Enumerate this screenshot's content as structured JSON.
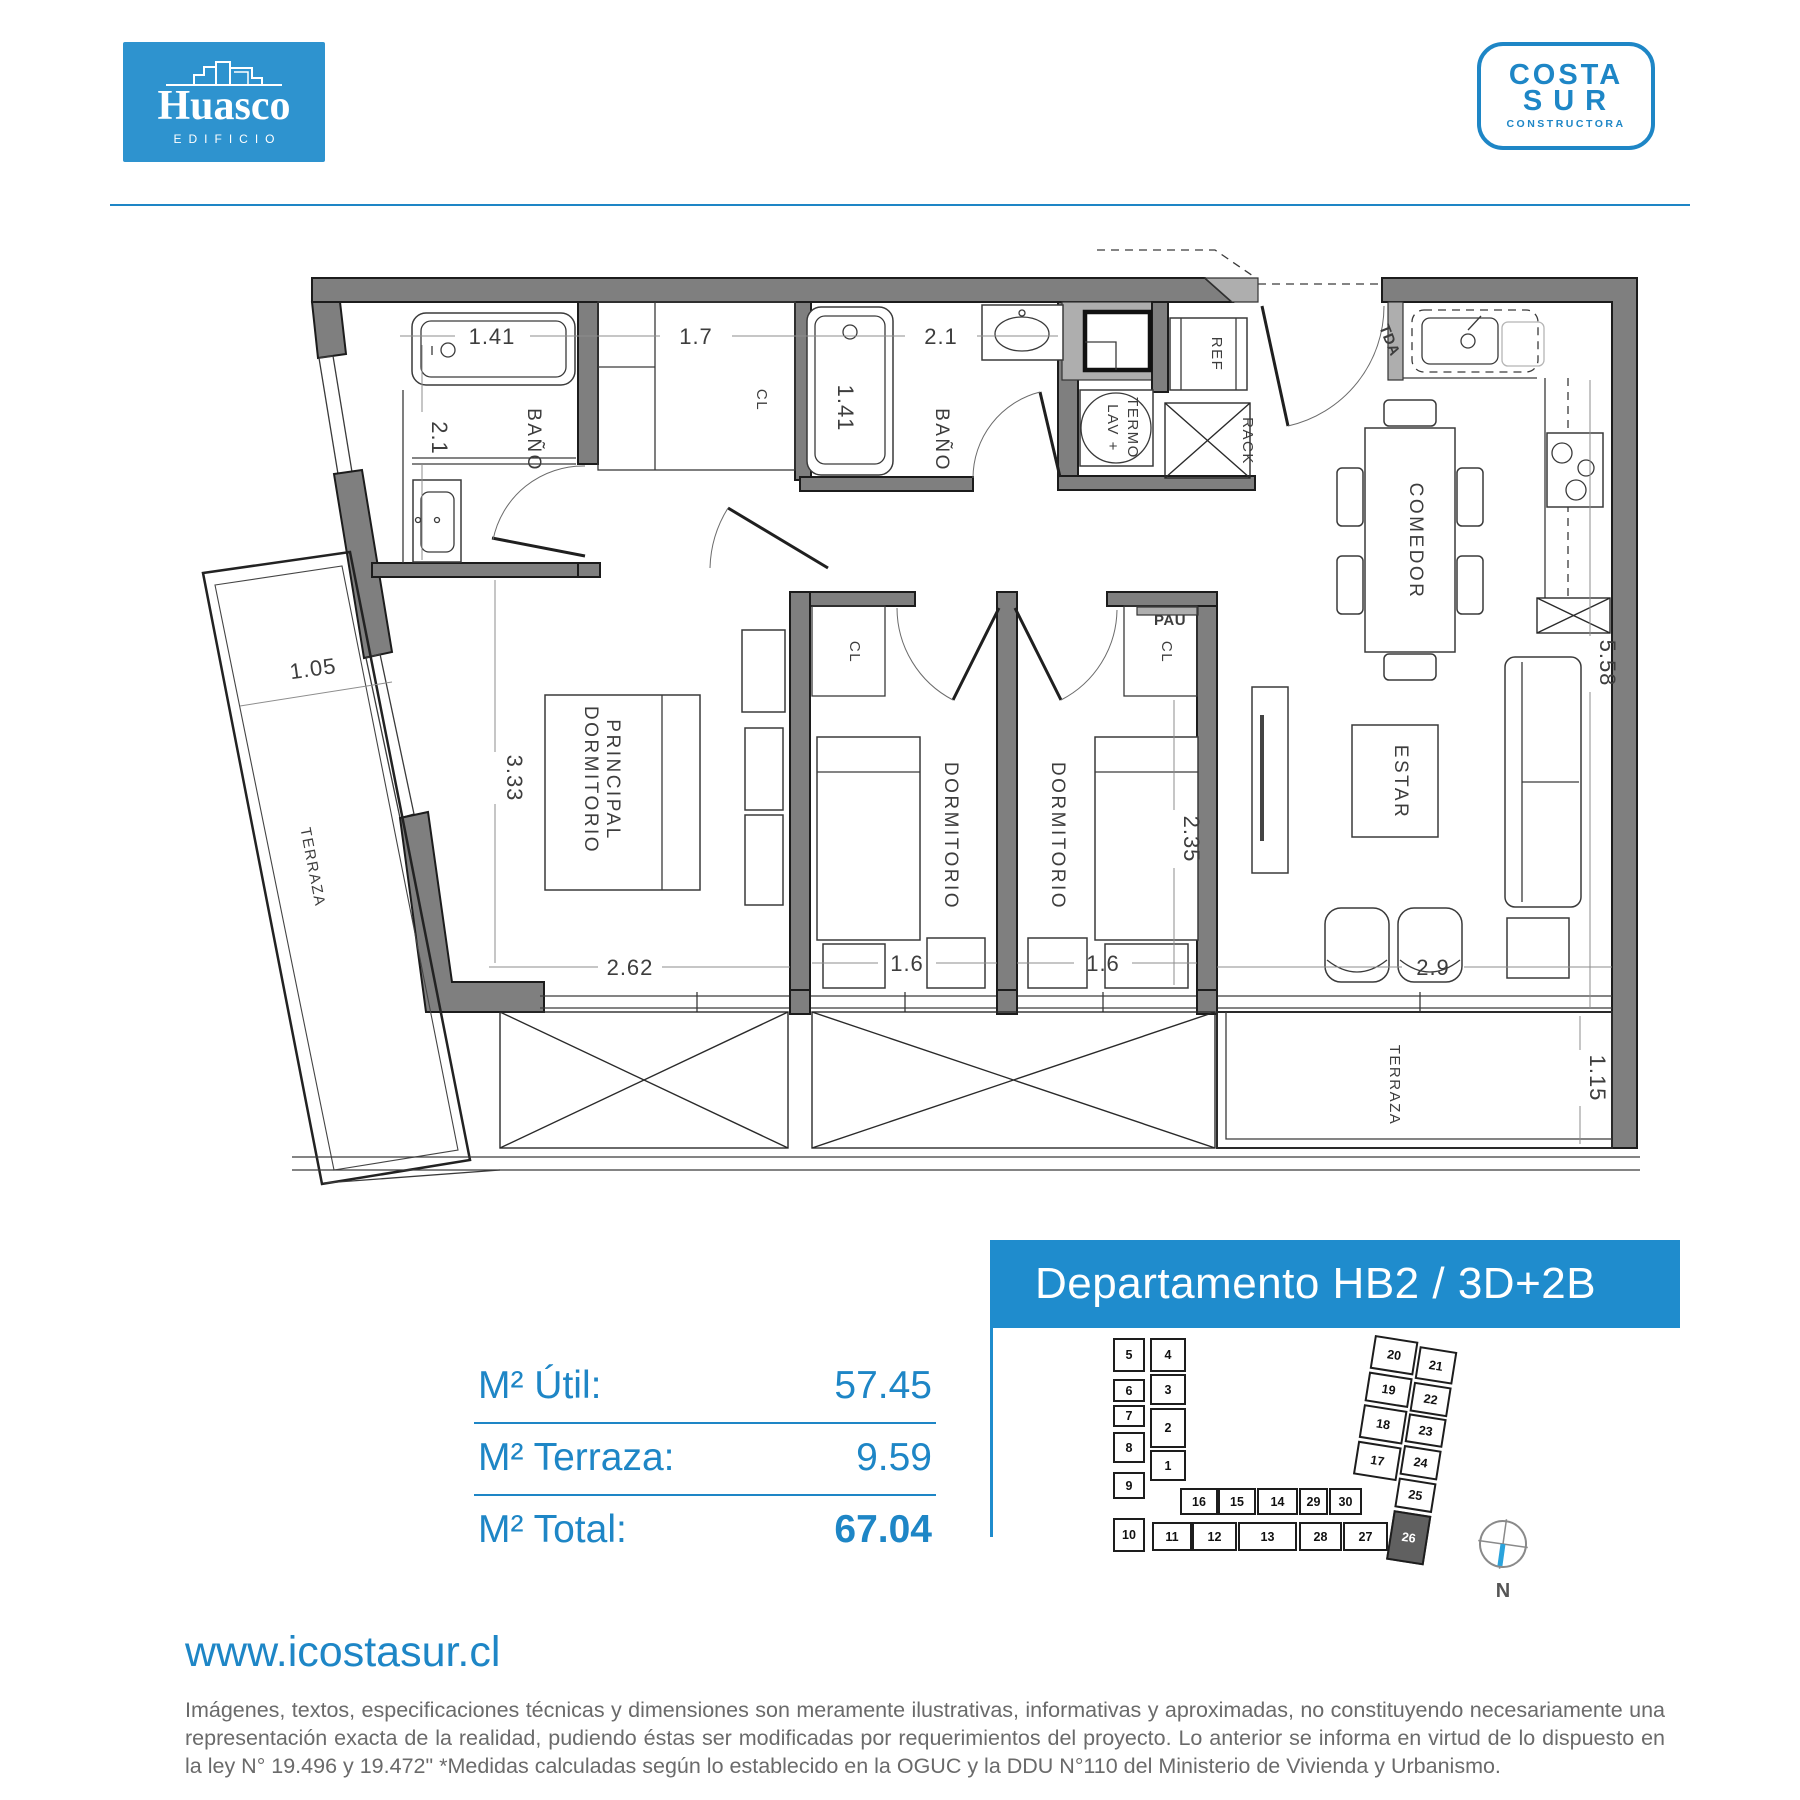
{
  "colors": {
    "brand_blue": "#1e86c6",
    "banner_blue": "#1f8ccd",
    "huasco_bg": "#2e93cf",
    "wall_gray": "#7f7f7f",
    "highlight_unit": "#606060"
  },
  "header": {
    "huasco": {
      "name": "Huasco",
      "subtitle": "EDIFICIO"
    },
    "costasur": {
      "line1": "COSTA",
      "line2": "SUR",
      "line3": "CONSTRUCTORA"
    }
  },
  "floorplan": {
    "labels": {
      "bano1": "BAÑO",
      "cl_hall": "CL",
      "bano2": "BAÑO",
      "lav1": "LAV +",
      "lav2": "TERMO",
      "ref": "REF",
      "rack": "RACK",
      "tda": "TDA",
      "comedor": "COMEDOR",
      "estar": "ESTAR",
      "dorm_ppal1": "DORMITORIO",
      "dorm_ppal2": "PRINCIPAL",
      "dorm2": "DORMITORIO",
      "dorm3": "DORMITORIO",
      "cl_d2": "CL",
      "cl_d3": "CL",
      "pau": "PAU",
      "terraza_izq": "TERRAZA",
      "terraza_der": "TERRAZA"
    },
    "dims": {
      "tina1": "1.41",
      "closet": "1.7",
      "vanitorio1": "2.1",
      "tina2": "1.41",
      "bano2": "2.1",
      "terraza_izq": "1.05",
      "dorm_ppal_alto": "3.33",
      "dorm_ppal_ancho": "2.62",
      "dorm2_ancho": "1.6",
      "dorm3_ancho": "1.6",
      "dorm3_alto": "2.35",
      "estar_ancho": "2.9",
      "cocina_alto": "5.58",
      "terraza_der_alto": "1.15"
    }
  },
  "unit": {
    "title": "Departamento HB2 / 3D+2B",
    "areas": [
      {
        "label": "M² Útil:",
        "value": "57.45"
      },
      {
        "label": "M² Terraza:",
        "value": "9.59"
      },
      {
        "label": "M² Total:",
        "value": "67.04"
      }
    ],
    "site": {
      "left_outer": [
        "5",
        "6",
        "7",
        "8",
        "9",
        "10"
      ],
      "left_inner": [
        "4",
        "3",
        "2",
        "1"
      ],
      "mid_top": [
        "16",
        "15",
        "14",
        "29",
        "30"
      ],
      "mid_bottom": [
        "11",
        "12",
        "13",
        "28",
        "27"
      ],
      "right_outer": [
        "20",
        "19",
        "18",
        "17"
      ],
      "right_inner": [
        "21",
        "22",
        "23",
        "24",
        "25",
        "26"
      ],
      "highlighted": "26",
      "compass": "N"
    }
  },
  "footer": {
    "website": "www.icostasur.cl",
    "disclaimer": "Imágenes, textos, especificaciones técnicas y dimensiones son meramente ilustrativas, informativas y aproximadas, no constituyendo necesariamente una representación exacta de la realidad, pudiendo éstas ser modificadas por requerimientos del proyecto. Lo anterior se informa en virtud de lo dispuesto en la ley N° 19.496 y 19.472\" *Medidas calculadas según lo establecido en la OGUC y la DDU N°110 del Ministerio de Vivienda y Urbanismo."
  }
}
